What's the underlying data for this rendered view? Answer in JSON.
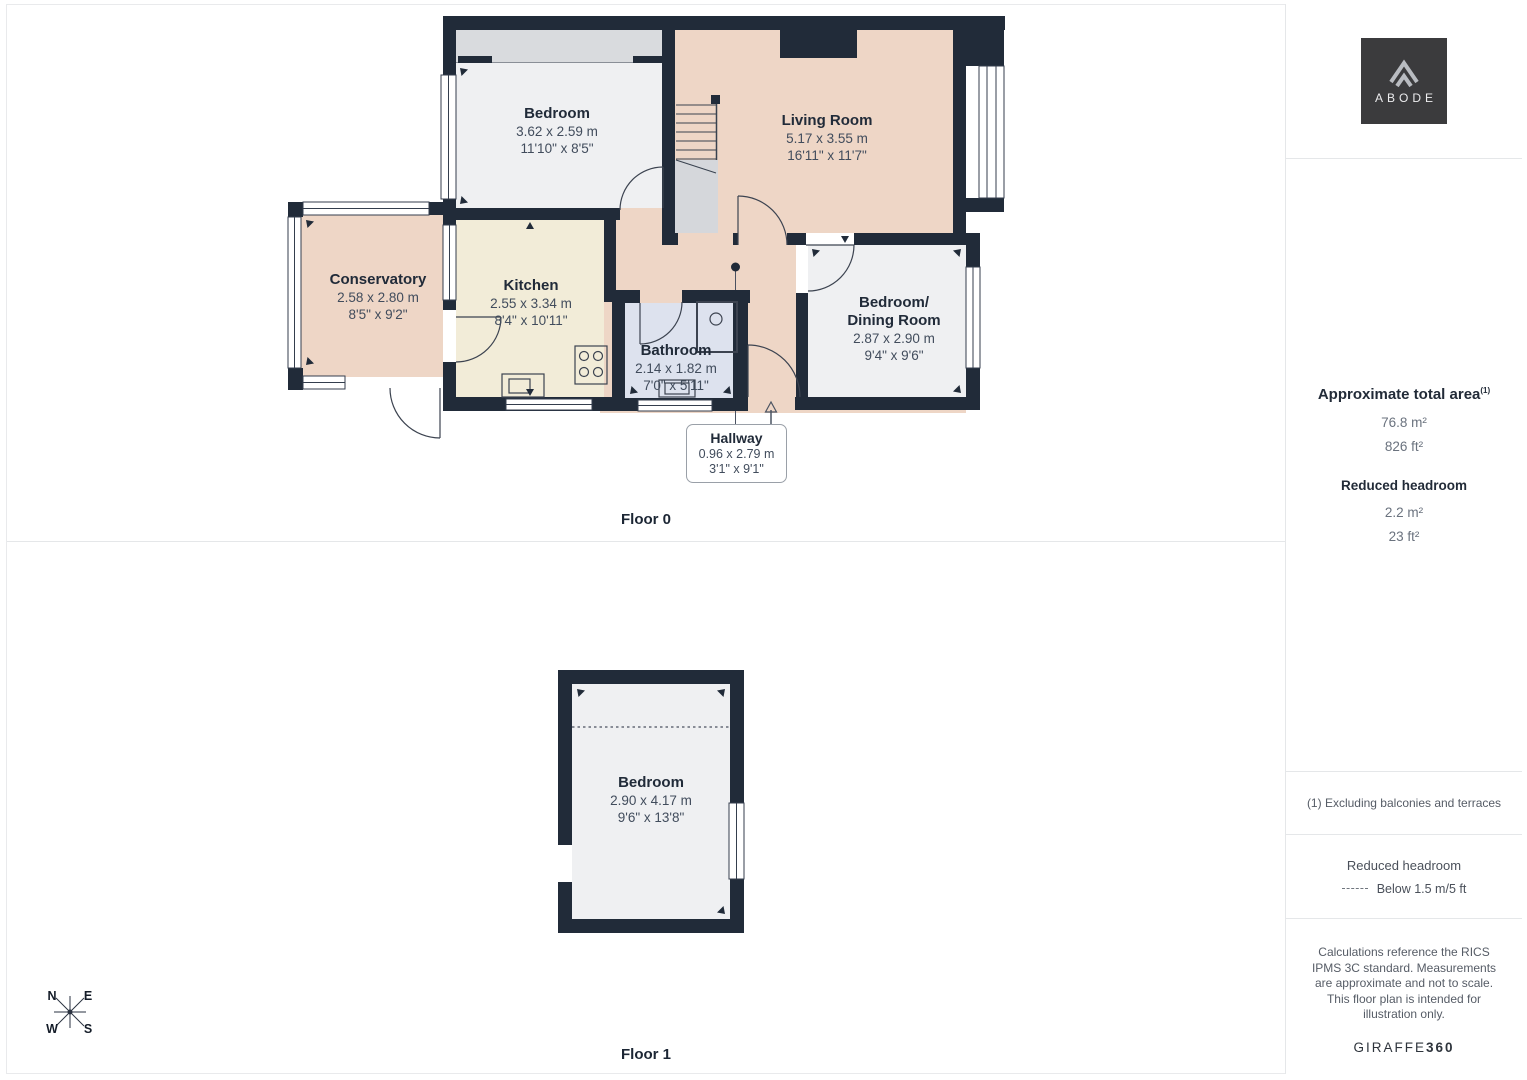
{
  "branding": {
    "logo_text": "ABODE",
    "footer_brand": "GIRAFFE",
    "footer_brand_bold": "360"
  },
  "floors": [
    {
      "label": "Floor 0"
    },
    {
      "label": "Floor 1"
    }
  ],
  "rooms": {
    "bedroom0": {
      "name": "Bedroom",
      "metric": "3.62 x 2.59 m",
      "imperial": "11'10\" x 8'5\""
    },
    "living": {
      "name": "Living Room",
      "metric": "5.17 x 3.55 m",
      "imperial": "16'11\" x 11'7\""
    },
    "conservatory": {
      "name": "Conservatory",
      "metric": "2.58 x 2.80 m",
      "imperial": "8'5\" x 9'2\""
    },
    "kitchen": {
      "name": "Kitchen",
      "metric": "2.55 x 3.34 m",
      "imperial": "8'4\" x 10'11\""
    },
    "bathroom": {
      "name": "Bathroom",
      "metric": "2.14 x 1.82 m",
      "imperial": "7'0\" x 5'11\""
    },
    "bedroom_dining": {
      "name": "Bedroom/",
      "name2": "Dining Room",
      "metric": "2.87 x 2.90 m",
      "imperial": "9'4\" x 9'6\""
    },
    "hallway": {
      "name": "Hallway",
      "metric": "0.96 x 2.79 m",
      "imperial": "3'1\" x 9'1\""
    },
    "bedroom1": {
      "name": "Bedroom",
      "metric": "2.90 x 4.17 m",
      "imperial": "9'6\" x 13'8\""
    }
  },
  "sidebar": {
    "area_title": "Approximate total area",
    "area_superscript": "(1)",
    "area_m2": "76.8 m²",
    "area_ft2": "826 ft²",
    "reduced_title": "Reduced headroom",
    "reduced_m2": "2.2 m²",
    "reduced_ft2": "23 ft²",
    "footnote": "(1) Excluding balconies and terraces",
    "legend_title": "Reduced headroom",
    "legend_item": "Below 1.5 m/5 ft",
    "disclaimer": "Calculations reference the RICS IPMS 3C standard. Measurements are approximate and not to scale. This floor plan is intended for illustration only."
  },
  "compass": {
    "n": "N",
    "e": "E",
    "s": "S",
    "w": "W"
  },
  "colors": {
    "wall": "#212b39",
    "room_pink": "#eed6c6",
    "room_cream": "#f2ecd8",
    "room_grey": "#eff0f2",
    "room_blue": "#dde2ee",
    "stairs_grey": "#d5d7db",
    "logo_bg": "#3b3b3d"
  }
}
